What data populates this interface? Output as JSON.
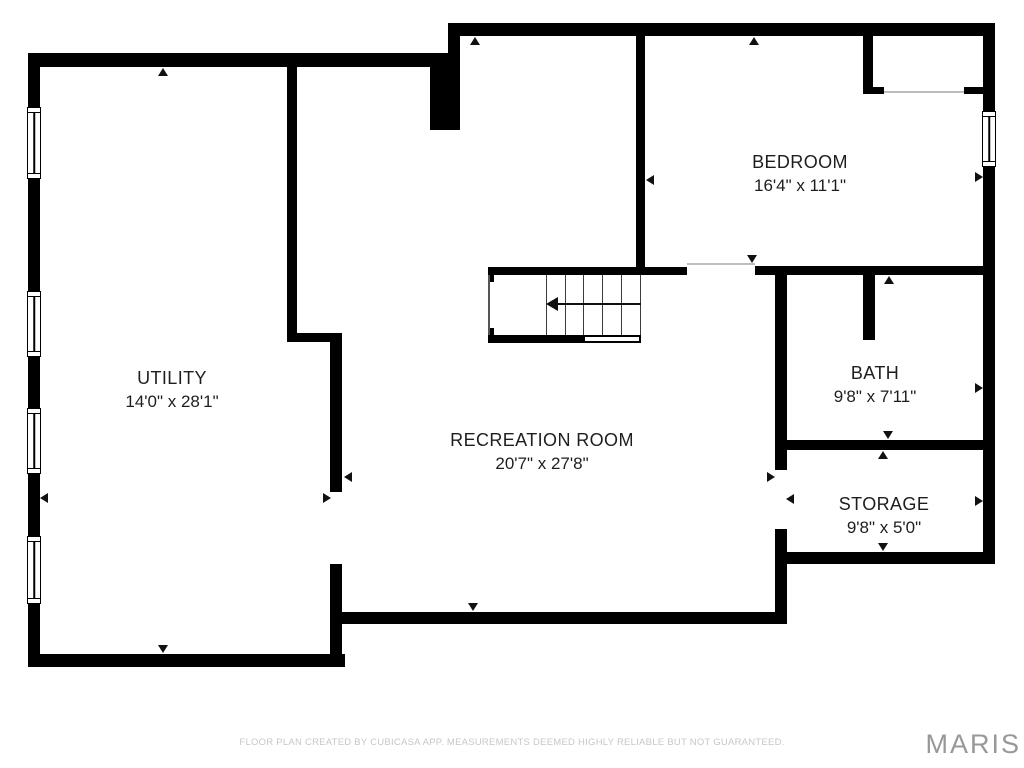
{
  "plan": {
    "background": "#ffffff",
    "wall_color": "#000000",
    "rooms": [
      {
        "id": "utility",
        "name": "UTILITY",
        "dims": "14'0\" x 28'1\"",
        "cx": 172,
        "cy": 390
      },
      {
        "id": "recreation-room",
        "name": "RECREATION ROOM",
        "dims": "20'7\" x 27'8\"",
        "cx": 542,
        "cy": 452
      },
      {
        "id": "bedroom",
        "name": "BEDROOM",
        "dims": "16'4\" x 11'1\"",
        "cx": 800,
        "cy": 174
      },
      {
        "id": "bath",
        "name": "BATH",
        "dims": "9'8\" x 7'11\"",
        "cx": 875,
        "cy": 385
      },
      {
        "id": "storage",
        "name": "STORAGE",
        "dims": "9'8\" x 5'0\"",
        "cx": 884,
        "cy": 516
      }
    ],
    "walls": [
      {
        "x": 28,
        "y": 53,
        "w": 12,
        "h": 614
      },
      {
        "x": 28,
        "y": 53,
        "w": 432,
        "h": 14
      },
      {
        "x": 430,
        "y": 67,
        "w": 30,
        "h": 63
      },
      {
        "x": 448,
        "y": 23,
        "w": 547,
        "h": 13
      },
      {
        "x": 448,
        "y": 36,
        "w": 12,
        "h": 17
      },
      {
        "x": 983,
        "y": 23,
        "w": 12,
        "h": 89
      },
      {
        "x": 983,
        "y": 166,
        "w": 12,
        "h": 398
      },
      {
        "x": 775,
        "y": 552,
        "w": 220,
        "h": 12
      },
      {
        "x": 28,
        "y": 654,
        "w": 317,
        "h": 13
      },
      {
        "x": 330,
        "y": 612,
        "w": 457,
        "h": 12
      },
      {
        "x": 287,
        "y": 67,
        "w": 10,
        "h": 275
      },
      {
        "x": 287,
        "y": 333,
        "w": 55,
        "h": 9
      },
      {
        "x": 330,
        "y": 342,
        "w": 12,
        "h": 150
      },
      {
        "x": 330,
        "y": 564,
        "w": 12,
        "h": 103
      },
      {
        "x": 636,
        "y": 36,
        "w": 9,
        "h": 239
      },
      {
        "x": 488,
        "y": 267,
        "w": 199,
        "h": 8
      },
      {
        "x": 755,
        "y": 266,
        "w": 228,
        "h": 9
      },
      {
        "x": 863,
        "y": 36,
        "w": 10,
        "h": 58
      },
      {
        "x": 863,
        "y": 87,
        "w": 21,
        "h": 7
      },
      {
        "x": 964,
        "y": 87,
        "w": 19,
        "h": 7
      },
      {
        "x": 863,
        "y": 275,
        "w": 12,
        "h": 65
      },
      {
        "x": 775,
        "y": 275,
        "w": 12,
        "h": 195
      },
      {
        "x": 775,
        "y": 529,
        "w": 12,
        "h": 95
      },
      {
        "x": 775,
        "y": 440,
        "w": 208,
        "h": 10
      },
      {
        "x": 488,
        "y": 335,
        "w": 95,
        "h": 8
      },
      {
        "x": 488,
        "y": 275,
        "w": 6,
        "h": 7
      },
      {
        "x": 488,
        "y": 328,
        "w": 6,
        "h": 7
      }
    ],
    "windows": [
      {
        "x": 27,
        "y": 107,
        "w": 14,
        "h": 72
      },
      {
        "x": 27,
        "y": 291,
        "w": 14,
        "h": 66
      },
      {
        "x": 27,
        "y": 408,
        "w": 14,
        "h": 66
      },
      {
        "x": 27,
        "y": 536,
        "w": 14,
        "h": 68
      },
      {
        "x": 982,
        "y": 111,
        "w": 14,
        "h": 56
      }
    ],
    "openings": [
      {
        "x": 687,
        "y": 263,
        "w": 68,
        "h": 2
      },
      {
        "x": 884,
        "y": 91,
        "w": 80,
        "h": 2
      }
    ],
    "markers": [
      {
        "x": 163,
        "y": 68,
        "dir": "up"
      },
      {
        "x": 475,
        "y": 37,
        "dir": "up"
      },
      {
        "x": 754,
        "y": 37,
        "dir": "up"
      },
      {
        "x": 646,
        "y": 180,
        "dir": "left"
      },
      {
        "x": 983,
        "y": 177,
        "dir": "right"
      },
      {
        "x": 752,
        "y": 263,
        "dir": "down"
      },
      {
        "x": 889,
        "y": 276,
        "dir": "up"
      },
      {
        "x": 888,
        "y": 439,
        "dir": "down"
      },
      {
        "x": 883,
        "y": 451,
        "dir": "up"
      },
      {
        "x": 983,
        "y": 388,
        "dir": "right"
      },
      {
        "x": 983,
        "y": 501,
        "dir": "right"
      },
      {
        "x": 883,
        "y": 551,
        "dir": "down"
      },
      {
        "x": 775,
        "y": 477,
        "dir": "right"
      },
      {
        "x": 786,
        "y": 499,
        "dir": "left"
      },
      {
        "x": 344,
        "y": 477,
        "dir": "left"
      },
      {
        "x": 331,
        "y": 498,
        "dir": "right"
      },
      {
        "x": 40,
        "y": 498,
        "dir": "left"
      },
      {
        "x": 473,
        "y": 611,
        "dir": "down"
      },
      {
        "x": 163,
        "y": 653,
        "dir": "down"
      }
    ],
    "stairs": {
      "treads_x": [
        546,
        565,
        583,
        602,
        621,
        640
      ],
      "y_top": 275,
      "y_bottom": 335,
      "left_line": {
        "x": 488,
        "y": 275,
        "h": 60
      },
      "open_edge": {
        "x": 583,
        "y": 335,
        "w": 58,
        "h": 8
      },
      "run_line": {
        "x1": 554,
        "x2": 641,
        "y": 303
      },
      "head": {
        "x": 546,
        "y": 304
      }
    }
  },
  "footer": {
    "disclaimer": "FLOOR PLAN CREATED BY CUBICASA APP. MEASUREMENTS DEEMED HIGHLY RELIABLE BUT NOT GUARANTEED."
  },
  "watermark": {
    "text": "MARIS",
    "color": "#98989b"
  }
}
